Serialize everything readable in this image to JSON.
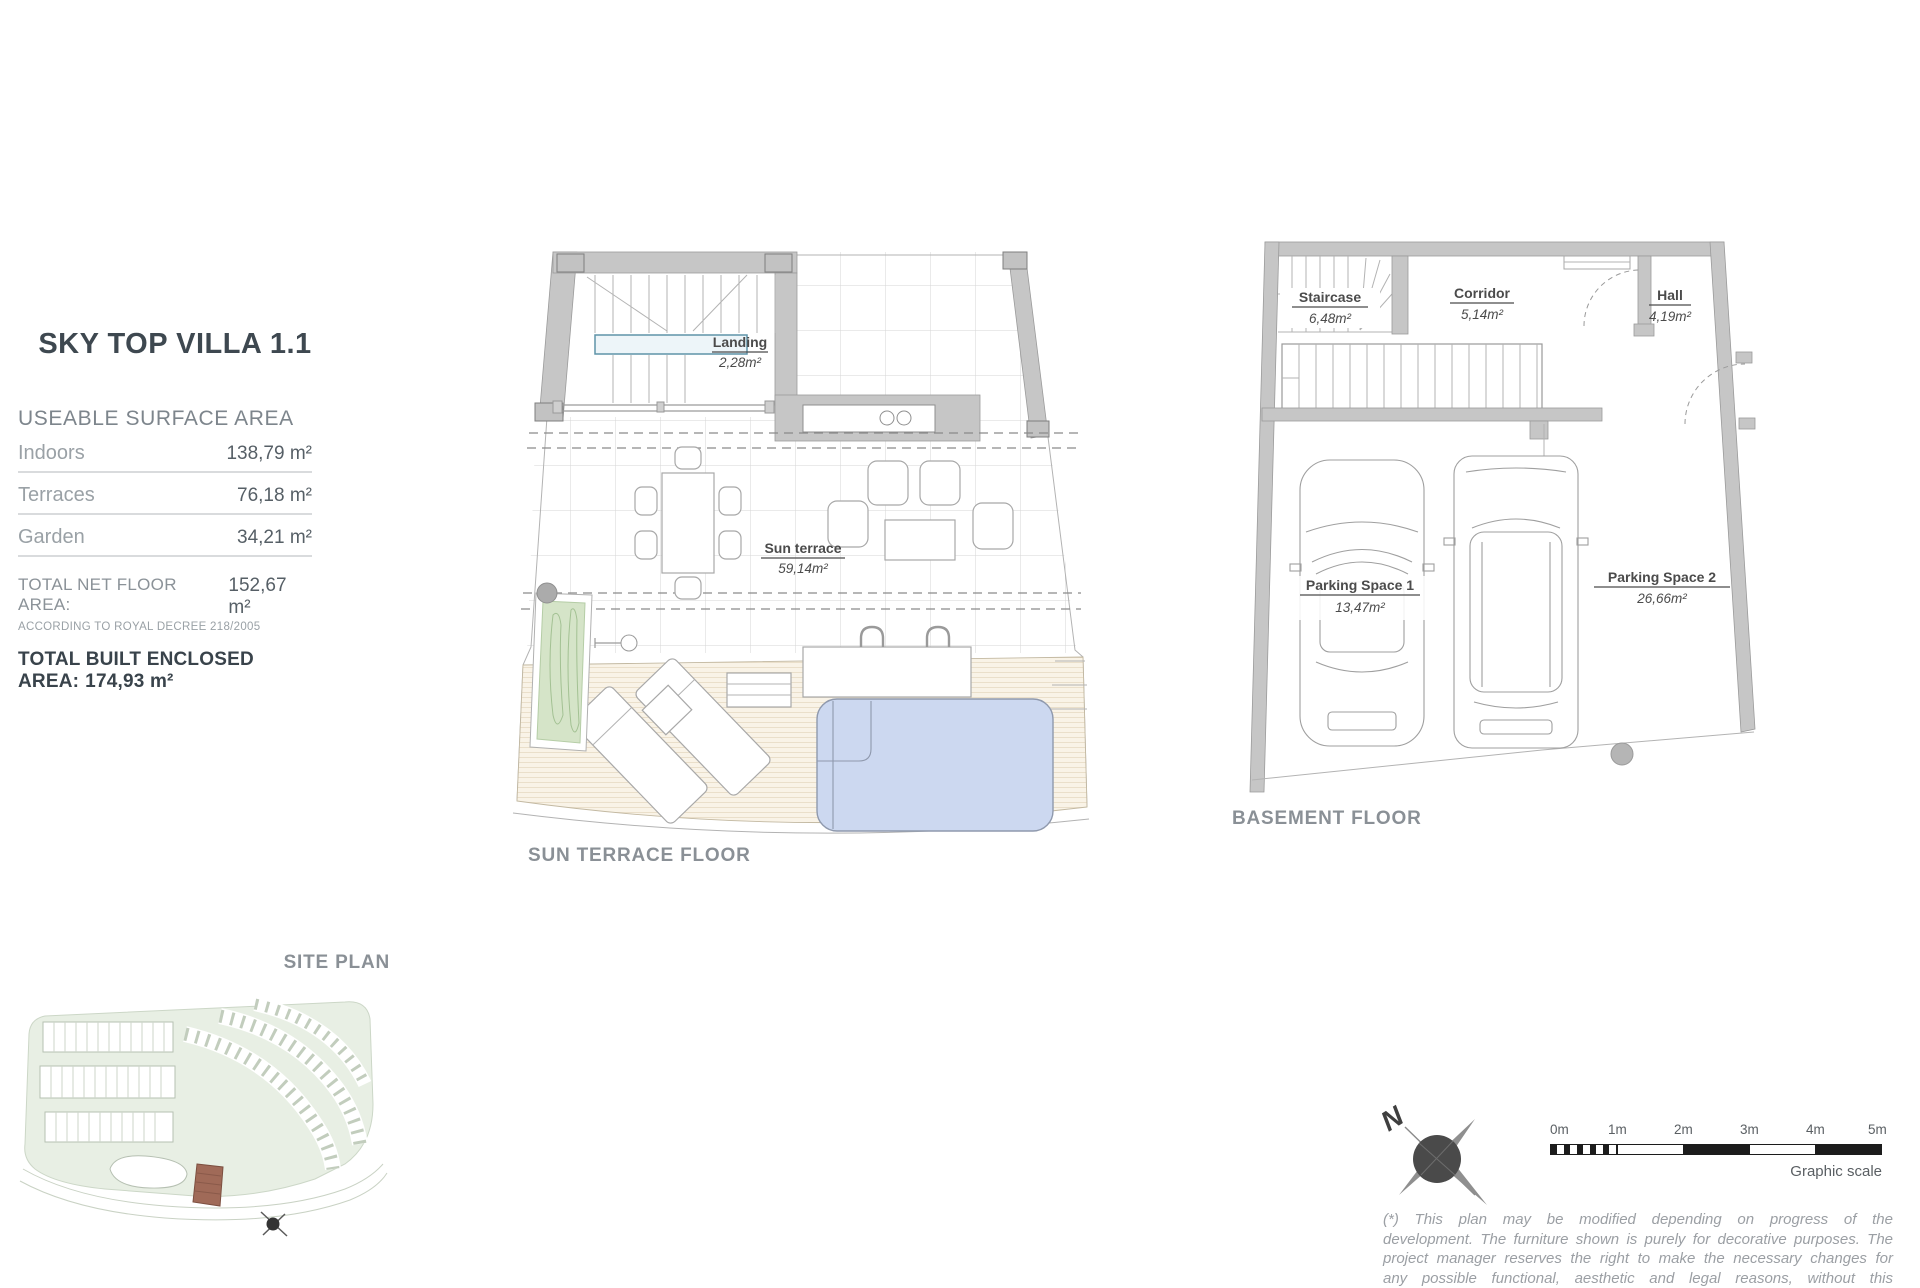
{
  "info_panel": {
    "title": "SKY TOP VILLA 1.1",
    "section_heading": "USEABLE SURFACE AREA",
    "rows": [
      {
        "label": "Indoors",
        "value": "138,79 m²"
      },
      {
        "label": "Terraces",
        "value": "76,18 m²"
      },
      {
        "label": "Garden",
        "value": "34,21 m²"
      }
    ],
    "total_net": {
      "label": "TOTAL NET FLOOR AREA:",
      "value": "152,67  m²",
      "note": "ACCORDING TO ROYAL DECREE 218/2005"
    },
    "total_built": {
      "label": "TOTAL BUILT ENCLOSED AREA:",
      "value": "174,93 m²"
    }
  },
  "sun_terrace_plan": {
    "caption": "SUN TERRACE FLOOR",
    "rooms": [
      {
        "name": "Landing",
        "area": "2,28m²"
      },
      {
        "name": "Sun terrace",
        "area": "59,14m²"
      }
    ]
  },
  "basement_plan": {
    "caption": "BASEMENT FLOOR",
    "rooms": [
      {
        "name": "Staircase",
        "area": "6,48m²"
      },
      {
        "name": "Corridor",
        "area": "5,14m²"
      },
      {
        "name": "Hall",
        "area": "4,19m²"
      },
      {
        "name": "Parking Space 1",
        "area": "13,47m²"
      },
      {
        "name": "Parking Space 2",
        "area": "26,66m²"
      }
    ]
  },
  "site_plan": {
    "caption": "SITE PLAN"
  },
  "compass": {
    "label": "N"
  },
  "scale_bar": {
    "ticks": [
      "0m",
      "1m",
      "2m",
      "3m",
      "4m",
      "5m"
    ],
    "caption": "Graphic scale"
  },
  "disclaimer": {
    "lines": [
      "(*) This plan may be modified depending on progress of the",
      "development. The furniture shown is purely for decorative purposes. The",
      "project manager reserves the right to make the necessary changes for",
      "any possible functional, aesthetic and legal reasons, without this"
    ]
  },
  "colors": {
    "pool": "#ccd8f0",
    "deck": "#f9f3e7",
    "planter": "#d5e4c8",
    "wall": "#c6c6c6",
    "site_green": "#e8efe4",
    "plot_highlight": "#a06a58",
    "title_text": "#3e4850",
    "muted_text": "#9aa1a6"
  }
}
